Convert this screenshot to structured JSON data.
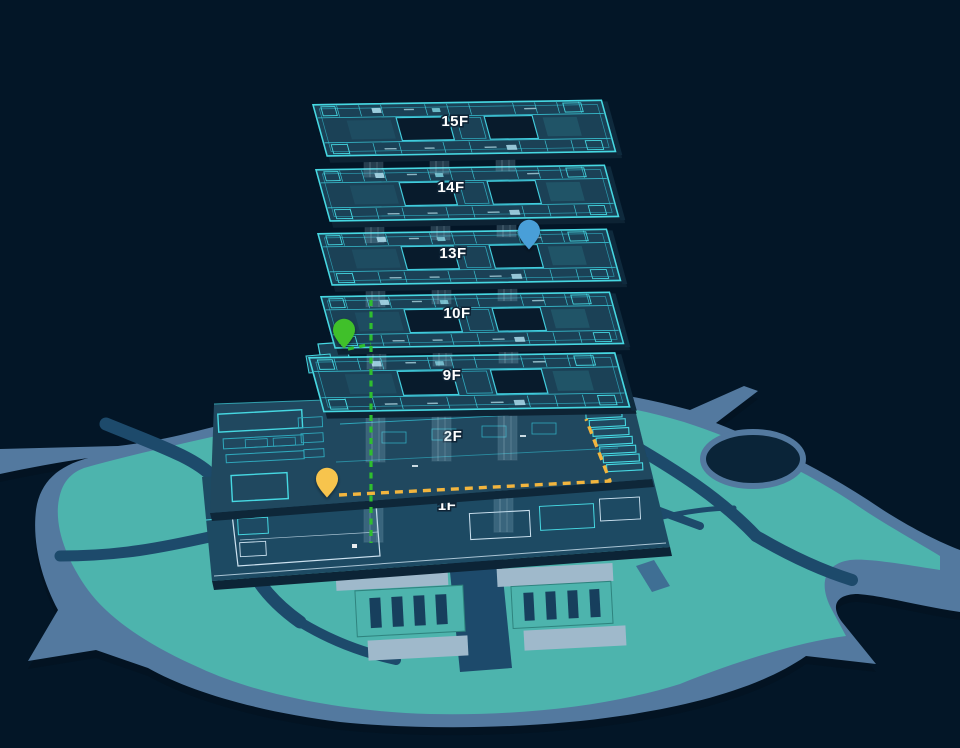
{
  "scene": {
    "type": "indoor-3d-map",
    "background_color": "#031627"
  },
  "building": {
    "floors": [
      {
        "id": "15F",
        "label": "15F"
      },
      {
        "id": "14F",
        "label": "14F"
      },
      {
        "id": "13F",
        "label": "13F"
      },
      {
        "id": "10F",
        "label": "10F"
      },
      {
        "id": "9F",
        "label": "9F"
      },
      {
        "id": "2F",
        "label": "2F"
      },
      {
        "id": "1F",
        "label": "1F"
      }
    ]
  },
  "markers": [
    {
      "id": "pin-blue",
      "color": "#4a9fd8",
      "floor": "13F"
    },
    {
      "id": "pin-green",
      "color": "#3fc02c",
      "floor": "9F"
    },
    {
      "id": "pin-amber",
      "color": "#f7c44d",
      "floor": "2F"
    }
  ],
  "routes": [
    {
      "id": "route-vertical-green",
      "color": "#2fbe2f",
      "style": "dashed"
    },
    {
      "id": "route-2f-amber",
      "color": "#f2b53e",
      "style": "dashed"
    }
  ],
  "palette": {
    "background": "#031627",
    "plate_fill": "#1b4156",
    "plate_side": "#0d2334",
    "wire_cyan": "#46d8e2",
    "wire_light": "#cde2f0",
    "island_green": "#4db4ad",
    "road_slate": "#53799f",
    "road_dark": "#1d4a6b",
    "pad_light": "#9fb9cb",
    "pond_dark": "#0a2438"
  }
}
